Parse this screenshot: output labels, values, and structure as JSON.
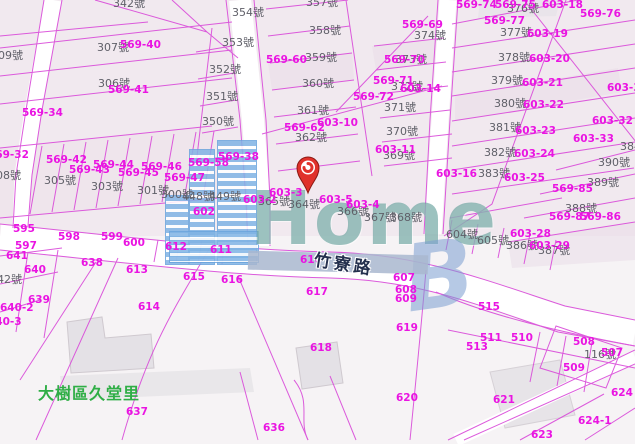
{
  "map": {
    "district_label": "大樹區久堂里",
    "road_label": "竹寮路",
    "watermark": {
      "home_text": "Home",
      "b_text": "B"
    },
    "pin": {
      "x": 307,
      "y": 172
    },
    "colors": {
      "parcel_line": "#d94ad9",
      "survey_text": "#ea14e2",
      "parcel_text": "#5f5f68",
      "district_text": "#2fae46",
      "road_text": "#24304e",
      "watermark_blue": "#7fb3e4",
      "watermark_teal": "#609c98",
      "background": "#f6f2f5"
    },
    "labels": [
      {
        "t": "342號",
        "x": 113,
        "y": -2,
        "c": "g"
      },
      {
        "t": "354號",
        "x": 232,
        "y": 7,
        "c": "g"
      },
      {
        "t": "353號",
        "x": 222,
        "y": 37,
        "c": "g"
      },
      {
        "t": "352號",
        "x": 209,
        "y": 64,
        "c": "g"
      },
      {
        "t": "351號",
        "x": 206,
        "y": 91,
        "c": "g"
      },
      {
        "t": "350號",
        "x": 202,
        "y": 116,
        "c": "g"
      },
      {
        "t": "309號",
        "x": -9,
        "y": 50,
        "c": "g"
      },
      {
        "t": "307號",
        "x": 97,
        "y": 42,
        "c": "g"
      },
      {
        "t": "306號",
        "x": 98,
        "y": 78,
        "c": "g"
      },
      {
        "t": "308號",
        "x": -11,
        "y": 170,
        "c": "g"
      },
      {
        "t": "305號",
        "x": 44,
        "y": 175,
        "c": "g"
      },
      {
        "t": "303號",
        "x": 91,
        "y": 181,
        "c": "g"
      },
      {
        "t": "301號",
        "x": 137,
        "y": 185,
        "c": "g"
      },
      {
        "t": "300號",
        "x": 161,
        "y": 189,
        "c": "g"
      },
      {
        "t": "448號",
        "x": 182,
        "y": 191,
        "c": "g"
      },
      {
        "t": "449號",
        "x": 209,
        "y": 191,
        "c": "g"
      },
      {
        "t": "357號",
        "x": 306,
        "y": -3,
        "c": "g"
      },
      {
        "t": "358號",
        "x": 309,
        "y": 25,
        "c": "g"
      },
      {
        "t": "359號",
        "x": 305,
        "y": 52,
        "c": "g"
      },
      {
        "t": "360號",
        "x": 302,
        "y": 78,
        "c": "g"
      },
      {
        "t": "361號",
        "x": 297,
        "y": 105,
        "c": "g"
      },
      {
        "t": "362號",
        "x": 295,
        "y": 132,
        "c": "g"
      },
      {
        "t": "374號",
        "x": 414,
        "y": 30,
        "c": "g"
      },
      {
        "t": "373號",
        "x": 395,
        "y": 54,
        "c": "g"
      },
      {
        "t": "372號",
        "x": 391,
        "y": 81,
        "c": "g"
      },
      {
        "t": "371號",
        "x": 384,
        "y": 102,
        "c": "g"
      },
      {
        "t": "370號",
        "x": 386,
        "y": 126,
        "c": "g"
      },
      {
        "t": "369號",
        "x": 383,
        "y": 150,
        "c": "g"
      },
      {
        "t": "376號",
        "x": 507,
        "y": 3,
        "c": "g"
      },
      {
        "t": "377號",
        "x": 500,
        "y": 27,
        "c": "g"
      },
      {
        "t": "378號",
        "x": 498,
        "y": 52,
        "c": "g"
      },
      {
        "t": "379號",
        "x": 491,
        "y": 75,
        "c": "g"
      },
      {
        "t": "380號",
        "x": 494,
        "y": 98,
        "c": "g"
      },
      {
        "t": "381號",
        "x": 489,
        "y": 122,
        "c": "g"
      },
      {
        "t": "382號",
        "x": 484,
        "y": 147,
        "c": "g"
      },
      {
        "t": "383號",
        "x": 478,
        "y": 168,
        "c": "g"
      },
      {
        "t": "384號",
        "x": 620,
        "y": 141,
        "c": "g"
      },
      {
        "t": "390號",
        "x": 598,
        "y": 157,
        "c": "g"
      },
      {
        "t": "389號",
        "x": 587,
        "y": 177,
        "c": "g"
      },
      {
        "t": "388號",
        "x": 565,
        "y": 203,
        "c": "g"
      },
      {
        "t": "386號",
        "x": 506,
        "y": 240,
        "c": "g"
      },
      {
        "t": "387號",
        "x": 538,
        "y": 245,
        "c": "g"
      },
      {
        "t": "364號",
        "x": 288,
        "y": 199,
        "c": "g"
      },
      {
        "t": "365號",
        "x": 258,
        "y": 196,
        "c": "g"
      },
      {
        "t": "366號",
        "x": 337,
        "y": 206,
        "c": "g"
      },
      {
        "t": "367號",
        "x": 364,
        "y": 212,
        "c": "g"
      },
      {
        "t": "368號",
        "x": 390,
        "y": 212,
        "c": "g"
      },
      {
        "t": "116號",
        "x": 584,
        "y": 349,
        "c": "g"
      },
      {
        "t": "604號",
        "x": 446,
        "y": 229,
        "c": "g"
      },
      {
        "t": "605號",
        "x": 477,
        "y": 235,
        "c": "g"
      },
      {
        "t": "642號",
        "x": -10,
        "y": 274,
        "c": "g"
      },
      {
        "t": "569-40",
        "x": 120,
        "y": 40,
        "c": "m"
      },
      {
        "t": "569-41",
        "x": 108,
        "y": 85,
        "c": "m"
      },
      {
        "t": "569-34",
        "x": 22,
        "y": 108,
        "c": "m"
      },
      {
        "t": "569-32",
        "x": -12,
        "y": 150,
        "c": "m"
      },
      {
        "t": "569-42",
        "x": 46,
        "y": 155,
        "c": "m"
      },
      {
        "t": "569-43",
        "x": 69,
        "y": 165,
        "c": "m"
      },
      {
        "t": "569-44",
        "x": 93,
        "y": 160,
        "c": "m"
      },
      {
        "t": "569-45",
        "x": 118,
        "y": 168,
        "c": "m"
      },
      {
        "t": "569-46",
        "x": 141,
        "y": 162,
        "c": "m"
      },
      {
        "t": "569-47",
        "x": 164,
        "y": 173,
        "c": "m"
      },
      {
        "t": "569-58",
        "x": 188,
        "y": 158,
        "c": "m"
      },
      {
        "t": "569-60",
        "x": 266,
        "y": 55,
        "c": "m"
      },
      {
        "t": "569-62",
        "x": 284,
        "y": 123,
        "c": "m"
      },
      {
        "t": "569-38",
        "x": 218,
        "y": 152,
        "c": "m"
      },
      {
        "t": "602",
        "x": 193,
        "y": 207,
        "c": "m"
      },
      {
        "t": "603-2",
        "x": 243,
        "y": 195,
        "c": "m"
      },
      {
        "t": "603-3",
        "x": 269,
        "y": 188,
        "c": "m"
      },
      {
        "t": "603-5",
        "x": 319,
        "y": 195,
        "c": "m"
      },
      {
        "t": "603-4",
        "x": 346,
        "y": 200,
        "c": "m"
      },
      {
        "t": "603-10",
        "x": 317,
        "y": 118,
        "c": "m"
      },
      {
        "t": "603-11",
        "x": 375,
        "y": 145,
        "c": "m"
      },
      {
        "t": "603-14",
        "x": 400,
        "y": 84,
        "c": "m"
      },
      {
        "t": "569-69",
        "x": 402,
        "y": 20,
        "c": "m"
      },
      {
        "t": "569-70",
        "x": 384,
        "y": 55,
        "c": "m"
      },
      {
        "t": "569-71",
        "x": 373,
        "y": 76,
        "c": "m"
      },
      {
        "t": "569-72",
        "x": 353,
        "y": 92,
        "c": "m"
      },
      {
        "t": "569-74",
        "x": 456,
        "y": 0,
        "c": "m"
      },
      {
        "t": "569-75",
        "x": 495,
        "y": 0,
        "c": "m"
      },
      {
        "t": "569-76",
        "x": 580,
        "y": 9,
        "c": "m"
      },
      {
        "t": "569-77",
        "x": 484,
        "y": 16,
        "c": "m"
      },
      {
        "t": "603-18",
        "x": 542,
        "y": 0,
        "c": "m"
      },
      {
        "t": "603-19",
        "x": 527,
        "y": 29,
        "c": "m"
      },
      {
        "t": "603-20",
        "x": 529,
        "y": 54,
        "c": "m"
      },
      {
        "t": "603-21",
        "x": 522,
        "y": 78,
        "c": "m"
      },
      {
        "t": "603-22",
        "x": 523,
        "y": 100,
        "c": "m"
      },
      {
        "t": "603-23",
        "x": 515,
        "y": 126,
        "c": "m"
      },
      {
        "t": "603-24",
        "x": 514,
        "y": 149,
        "c": "m"
      },
      {
        "t": "603-25",
        "x": 504,
        "y": 173,
        "c": "m"
      },
      {
        "t": "603-31",
        "x": 607,
        "y": 83,
        "c": "m"
      },
      {
        "t": "603-32",
        "x": 592,
        "y": 116,
        "c": "m"
      },
      {
        "t": "603-33",
        "x": 573,
        "y": 134,
        "c": "m"
      },
      {
        "t": "603-16",
        "x": 436,
        "y": 169,
        "c": "m"
      },
      {
        "t": "569-85",
        "x": 552,
        "y": 184,
        "c": "m"
      },
      {
        "t": "569-86",
        "x": 580,
        "y": 212,
        "c": "m"
      },
      {
        "t": "569-87",
        "x": 549,
        "y": 212,
        "c": "m"
      },
      {
        "t": "603-28",
        "x": 510,
        "y": 229,
        "c": "m"
      },
      {
        "t": "603-29",
        "x": 529,
        "y": 241,
        "c": "m"
      },
      {
        "t": "595",
        "x": 13,
        "y": 224,
        "c": "m"
      },
      {
        "t": "597",
        "x": 15,
        "y": 241,
        "c": "m"
      },
      {
        "t": "598",
        "x": 58,
        "y": 232,
        "c": "m"
      },
      {
        "t": "599",
        "x": 101,
        "y": 232,
        "c": "m"
      },
      {
        "t": "600",
        "x": 123,
        "y": 238,
        "c": "m"
      },
      {
        "t": "641",
        "x": 6,
        "y": 251,
        "c": "m"
      },
      {
        "t": "640",
        "x": 24,
        "y": 265,
        "c": "m"
      },
      {
        "t": "640-2",
        "x": 0,
        "y": 303,
        "c": "m"
      },
      {
        "t": "640-3",
        "x": -12,
        "y": 317,
        "c": "m"
      },
      {
        "t": "639",
        "x": 28,
        "y": 295,
        "c": "m"
      },
      {
        "t": "638",
        "x": 81,
        "y": 258,
        "c": "m"
      },
      {
        "t": "613",
        "x": 126,
        "y": 265,
        "c": "m"
      },
      {
        "t": "615",
        "x": 183,
        "y": 272,
        "c": "m"
      },
      {
        "t": "614",
        "x": 138,
        "y": 302,
        "c": "m"
      },
      {
        "t": "612",
        "x": 165,
        "y": 242,
        "c": "m"
      },
      {
        "t": "611",
        "x": 210,
        "y": 245,
        "c": "m"
      },
      {
        "t": "610",
        "x": 300,
        "y": 255,
        "c": "m"
      },
      {
        "t": "616",
        "x": 221,
        "y": 275,
        "c": "m"
      },
      {
        "t": "617",
        "x": 306,
        "y": 287,
        "c": "m"
      },
      {
        "t": "618",
        "x": 310,
        "y": 343,
        "c": "m"
      },
      {
        "t": "607",
        "x": 393,
        "y": 273,
        "c": "m"
      },
      {
        "t": "608",
        "x": 395,
        "y": 285,
        "c": "m"
      },
      {
        "t": "609",
        "x": 395,
        "y": 294,
        "c": "m"
      },
      {
        "t": "619",
        "x": 396,
        "y": 323,
        "c": "m"
      },
      {
        "t": "515",
        "x": 478,
        "y": 302,
        "c": "m"
      },
      {
        "t": "511",
        "x": 480,
        "y": 333,
        "c": "m"
      },
      {
        "t": "510",
        "x": 511,
        "y": 333,
        "c": "m"
      },
      {
        "t": "513",
        "x": 466,
        "y": 342,
        "c": "m"
      },
      {
        "t": "508",
        "x": 573,
        "y": 337,
        "c": "m"
      },
      {
        "t": "507",
        "x": 601,
        "y": 348,
        "c": "m"
      },
      {
        "t": "509",
        "x": 563,
        "y": 363,
        "c": "m"
      },
      {
        "t": "621",
        "x": 493,
        "y": 395,
        "c": "m"
      },
      {
        "t": "624",
        "x": 611,
        "y": 388,
        "c": "m"
      },
      {
        "t": "624-1",
        "x": 578,
        "y": 416,
        "c": "m"
      },
      {
        "t": "623",
        "x": 531,
        "y": 430,
        "c": "m"
      },
      {
        "t": "636",
        "x": 263,
        "y": 423,
        "c": "m"
      },
      {
        "t": "620",
        "x": 396,
        "y": 393,
        "c": "m"
      },
      {
        "t": "637",
        "x": 126,
        "y": 407,
        "c": "m"
      }
    ]
  }
}
